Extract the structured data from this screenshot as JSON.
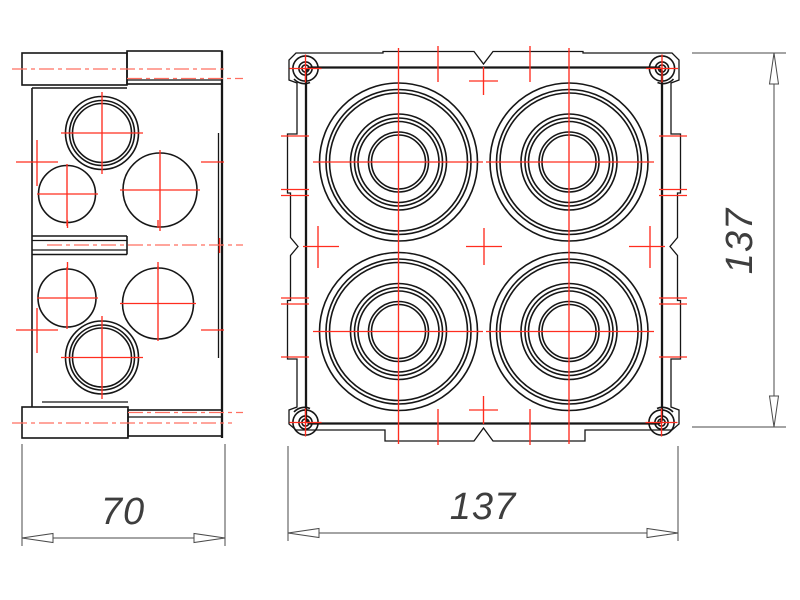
{
  "drawing": {
    "type": "technical-drawing-junction-box",
    "colors": {
      "background": "#ffffff",
      "outline": "#161616",
      "center_mark": "#ff2d1f",
      "centerline": "#ff6f61",
      "dimension_line": "#4a4a4a",
      "dimension_text": "#3e3e3e"
    },
    "dimensions": {
      "side_width": {
        "value": "70",
        "orientation": "horizontal"
      },
      "front_width": {
        "value": "137",
        "orientation": "horizontal"
      },
      "front_height": {
        "value": "137",
        "orientation": "vertical"
      }
    }
  }
}
